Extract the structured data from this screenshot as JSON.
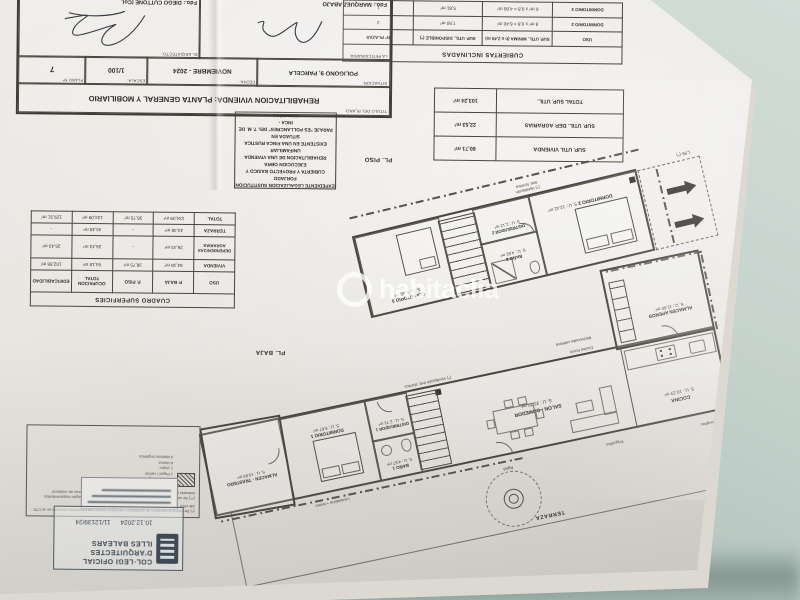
{
  "watermark": {
    "text": "habitaclia"
  },
  "sheet": {
    "plan_labels": {
      "pl_piso": "PL. PISO",
      "pl_baja": "PL. BAJA"
    },
    "cubiertas_table": {
      "title": "CUBIERTAS INCLINADAS",
      "headers": {
        "uso": "USO",
        "minima": "SUP. UTIL. MINIMA (h ≥ 2,40 m)",
        "disponible": "SUP. UTIL. DISPONIBLE (*)",
        "plazas": "Nº PLAZAS"
      },
      "rows": [
        {
          "uso": "DORMITORIO 2",
          "minima": "8 m² x 0,8 = 6,40 m²",
          "disponible": "7,50 m²",
          "plazas": "2"
        },
        {
          "uso": "DORMITORIO 3",
          "minima": "6 m² x 0,8 = 4,80 m²",
          "disponible": "5,81 m²",
          "plazas": "1"
        }
      ]
    },
    "resumen_table": {
      "rows": [
        {
          "label": "SUP. UTIL VIVIENDA",
          "value": "80,71 m²"
        },
        {
          "label": "SUP. UTIL. DEP. AGRARIAS",
          "value": "22,53 m²"
        },
        {
          "label": "TOTAL SUP. UTIL.",
          "value": "103,24 m²"
        }
      ]
    },
    "superficies_table": {
      "title": "CUADRO SUPERFICIES",
      "headers": [
        "USO",
        "P. BAJA",
        "P. PISO",
        "OCUPACION TOTAL",
        "EDIFICABILIDAD"
      ],
      "rows": [
        [
          "VIVIENDA",
          "64,18 m²",
          "38,75 m²",
          "64,18 m²",
          "102,88 m²"
        ],
        [
          "DEPENDENCIAS AGRARIAS",
          "26,43 m²",
          "-",
          "26,43 m²",
          "26,43 m²"
        ],
        [
          "TERRAZA",
          "43,48 m²",
          "-",
          "43,48 m²",
          "-"
        ],
        [
          "TOTAL",
          "134,09 m²",
          "38,75 m²",
          "134,09 m²",
          "129,31 m²"
        ]
      ]
    },
    "pl_piso": {
      "rooms": {
        "dorm2": {
          "name": "DORMITORIO 2",
          "area": "S. U.: 12,42 m²"
        },
        "bano2": {
          "name": "BAÑO 2",
          "area": "S. U.: 4,82 m²"
        },
        "distr2": {
          "name": "DISTRIBUIDOR 2",
          "area": "S. U.: 2,12 m²"
        },
        "dorm3": {
          "name": "DORMITORIO 3",
          "area": "S. U.: 6,85 m²"
        }
      },
      "dimension": "1,98 (*)",
      "vent_note_1": "(*) Ventilación",
      "vent_note_2": "Inst. térmica"
    },
    "pl_baja": {
      "rooms": {
        "salon": {
          "name": "SALON - COMEDOR",
          "area": "S. U.: 33,70 m²"
        },
        "cocina": {
          "name": "COCINA",
          "area": "S. U.: 10,23 m²"
        },
        "aperos": {
          "name": "ALMACEN APEROS",
          "area": "S. U.: 11,60 m²"
        },
        "distr1": {
          "name": "DISTRIBUIDOR 1",
          "area": "S. U.: 2,73 m²"
        },
        "bano1": {
          "name": "BAÑO 1",
          "area": "S. U.: 4,57 m²"
        },
        "dorm1": {
          "name": "DORMITORIO 1",
          "area": "S. U.: 9,67 m²"
        },
        "trastero": {
          "name": "ALMACEN - TRASTERO",
          "area": "S. U.: 10,93 m²"
        }
      },
      "terraza": "TERRAZA",
      "agua": "Agua",
      "frigorifico": "Frigorífico",
      "lavavajillas": "Lavavajillas",
      "lavanderia": "Lavandería + termo",
      "cocina_horno": "Cocina horno",
      "microondas": "Microondas cafetera",
      "vent_note": "(*) Ventilación Inst. térmica"
    },
    "expediente_lines": [
      "EXPEDIENTE LEGALIZACION SUSTITUCION FORJADO",
      "CUBIERTA Y PROYECTO BASICO Y EJECUCION OBRA",
      "REHABILITACION DE UNA VIVIENDA UNIFAMILIAR",
      "EXISTENTE EN UNA FINCA RUSTICA SITUADA EN",
      "PARAJE \"ES POLLANCRES\" DEL T. M. DE INCA -",
      "MALLORCA"
    ],
    "title_block": {
      "titulo_label": "TITULO DEL PLANO:",
      "titulo": "REHABILITACION VIVIENDA: PLANTA GENERAL Y MOBILIARIO",
      "situacion_label": "SITUACION:",
      "situacion": "POLIGONO 9, PARCELA",
      "fecha_label": "FECHA:",
      "fecha": "NOVIEMBRE - 2024",
      "escala_label": "ESCALA:",
      "escala": "1/100",
      "plano_label": "PLANO Nº",
      "plano": "7",
      "peticionaria_label": "LA PETICIONARIA:",
      "peticionaria_fdo": "Fdo.: MARQUEZ ABAJO",
      "arquitecto_label": "EL ARQUITECTO:",
      "arquitecto_fdo": "Fdo.: DIEGO CUTTONE (Col."
    },
    "notes": {
      "note1": "(*) Se indica la previsión de ventilación mecánica según requerimientos indicado en el CTE - DB HS3 \"Salubritat i Calidad del aire interior\"",
      "note2": "(**) Se señala el espacio de almacenaje inmediato de residuos según requerimientos indicado en el CTE - DB HS2 \"Salubridad\" i \"Recogida y evacuación de residuos\"",
      "legend_title": "Espacio almacenaje residuos de fracción:",
      "legend_items": [
        "1 Envases ligeros",
        "1 Papel / cartón",
        "1 Vidrio",
        "A Varios",
        "3 Matèria Orgànica"
      ]
    },
    "stamp": {
      "org1": "COL·LEGI OFICIAL",
      "org2": "D'ARQUITECTES",
      "org3": "ILLES BALEARS",
      "date": "10.12.2024",
      "number": "11/12139/24"
    }
  }
}
